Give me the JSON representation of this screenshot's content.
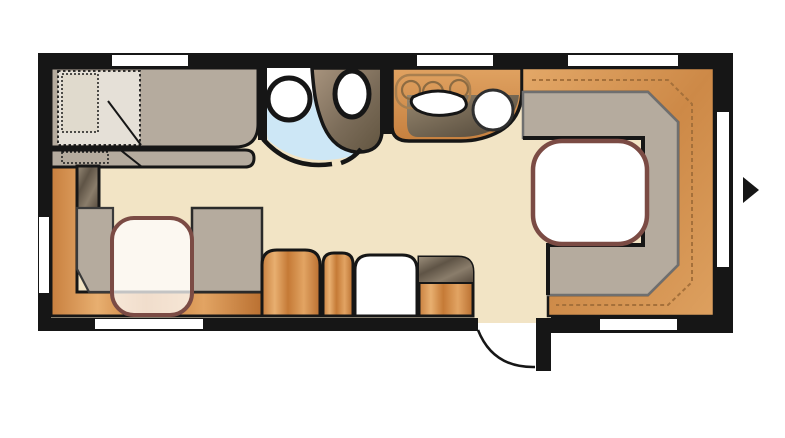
{
  "title": "caravan-floor-plan",
  "colors": {
    "background": "#ffffff",
    "wall": "#161616",
    "floor": "#f2e4c5",
    "floor_threshold": "#f2e4c5",
    "bathroom_floor": "#cde7f6",
    "window": "#ffffff",
    "upholstery_gray": "#b5ab9e",
    "upholstery_gray_border": "#6f6f6f",
    "backrest_border": "#3a3a3a",
    "duvet": "#e5e0d7",
    "pillow": "#e0dacd",
    "table_fill": "#ffffff",
    "table_fill_translucent": "rgba(255,255,255,0.75)",
    "table_border": "#7b4b44",
    "stitch": "#a5703a",
    "hob_outline": "#a87f4f",
    "burner_outline": "#8c6b42",
    "fixture_white": "#ffffff",
    "fixture_ring": "#161616",
    "sink_ring": "#2f2f2f",
    "outline": "#161616",
    "arrow": "#161616"
  },
  "furniture": [
    "double-bed",
    "pillow",
    "duvet",
    "wardrobe",
    "side-bench-seat",
    "dinette-backrest-left",
    "dinette-backrest-right",
    "dinette-table",
    "storage-ottoman-wide",
    "storage-ottoman-narrow",
    "white-cabinet",
    "drawer-cabinet",
    "shower",
    "toilet",
    "bathroom-door-arc",
    "kitchen-counter",
    "three-burner-hob",
    "kitchen-sink-basin",
    "kitchen-round-sink",
    "u-lounge-cushion",
    "u-lounge-backrest",
    "lounge-table",
    "entry-door",
    "entry-direction-arrow"
  ],
  "window_counts": {
    "top": 3,
    "bottom": 2,
    "left": 1,
    "right": 1
  }
}
